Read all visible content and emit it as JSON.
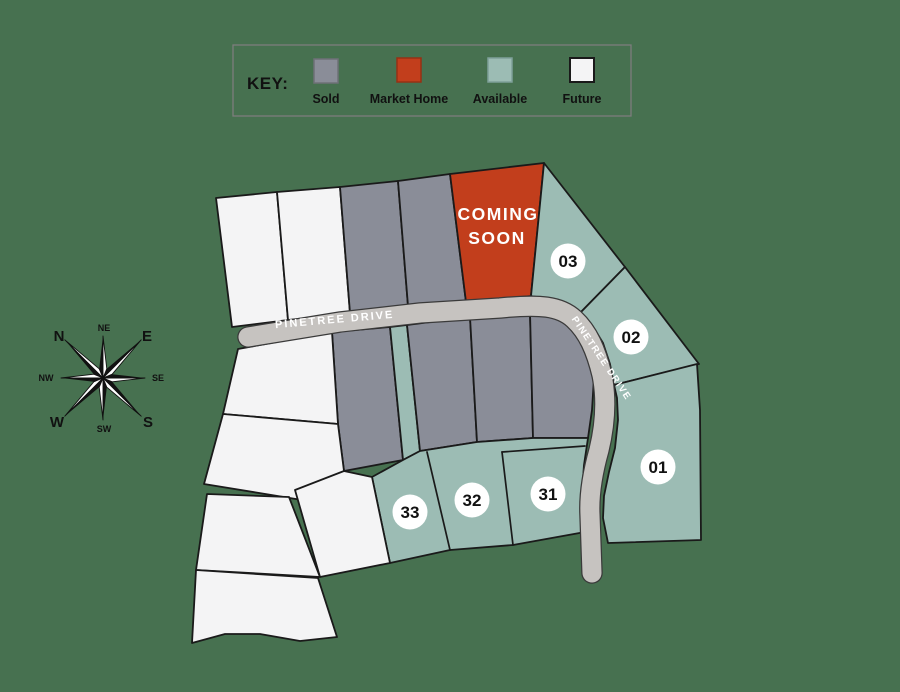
{
  "key": {
    "title": "KEY:",
    "items": [
      {
        "label": "Sold",
        "status": "sold",
        "color": "#8a8d98"
      },
      {
        "label": "Market Home",
        "status": "market_home",
        "color": "#c23e1c"
      },
      {
        "label": "Available",
        "status": "available",
        "color": "#9cbcb4"
      },
      {
        "label": "Future",
        "status": "future",
        "color": "#f4f4f5"
      }
    ]
  },
  "map": {
    "road": {
      "name": "PINETREE DRIVE"
    },
    "coming_soon_lot": {
      "status": "market_home",
      "label_line1": "COMING",
      "label_line2": "SOON"
    },
    "numbered_lots": [
      {
        "id": "01",
        "status": "available"
      },
      {
        "id": "02",
        "status": "available"
      },
      {
        "id": "03",
        "status": "available"
      },
      {
        "id": "31",
        "status": "available"
      },
      {
        "id": "32",
        "status": "available"
      },
      {
        "id": "33",
        "status": "available"
      }
    ]
  },
  "compass": {
    "labels": {
      "n": "N",
      "ne": "NE",
      "e": "E",
      "se": "SE",
      "s": "S",
      "sw": "SW",
      "w": "W",
      "nw": "NW"
    }
  },
  "colors": {
    "background": "#477150",
    "sold": "#8a8d98",
    "market_home": "#c23e1c",
    "available": "#9cbcb4",
    "future": "#f4f4f5",
    "road": "#c6c3c0",
    "road_casing": "#3a3a3a",
    "lot_border": "#1a1a1a",
    "badge_fill": "#ffffff",
    "text_dark": "#111111",
    "text_light": "#ffffff",
    "key_border": "#7d7d7d"
  }
}
